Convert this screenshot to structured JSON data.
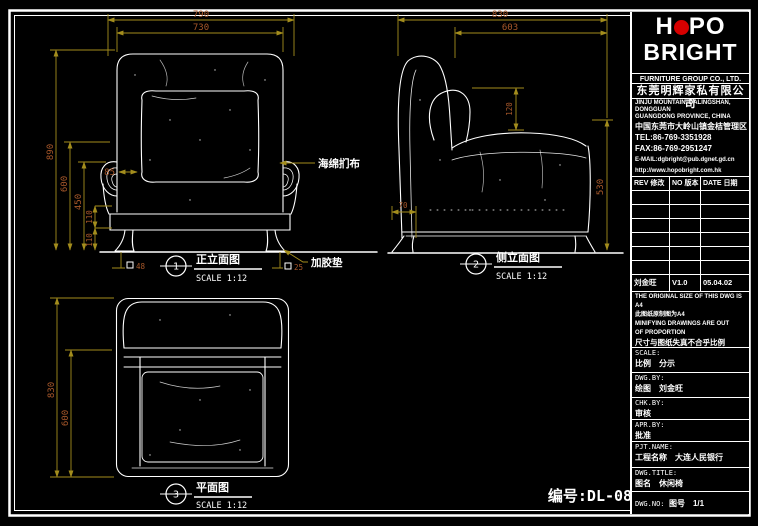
{
  "colors": {
    "dim_line": "#a38d1d",
    "dim_text": "#a8582a",
    "logo_red": "#d60000"
  },
  "frame": {
    "drawing_number": "编号:DL-08"
  },
  "views": {
    "front": {
      "number": "1",
      "title": "正立面图",
      "scale_label": "SCALE 1:12",
      "dims": {
        "width_outer": "790",
        "width_inner": "730",
        "height_total": "890",
        "height_back": "600",
        "height_arm": "450",
        "height_seat_upper": "110",
        "height_seat_lower": "110",
        "arm_width": "85",
        "leg_left": "48",
        "leg_right": "25"
      },
      "labels": {
        "upholstery": "海绵扪布",
        "glide": "加胶垫"
      }
    },
    "side": {
      "number": "2",
      "title": "侧立面图",
      "scale_label": "SCALE 1:12",
      "dims": {
        "depth_outer": "830",
        "depth_inner": "603",
        "back_offset": "120",
        "height_side": "530",
        "leg_inset": "70"
      }
    },
    "plan": {
      "number": "3",
      "title": "平面图",
      "scale_label": "SCALE 1:12",
      "dims": {
        "depth_outer": "830",
        "depth_seat": "600"
      }
    }
  },
  "title_block": {
    "logo": {
      "word1_a": "H",
      "word1_b": "PO",
      "word2": "BRIGHT"
    },
    "company_en": "FURNITURE GROUP CO., LTD.",
    "company_cn": "东莞明辉家私有限公司",
    "address_en_1": "JINJU MOUNTAIN, DALINGSHAN, DONGGUAN",
    "address_en_2": "GUANGDONG PROVINCE, CHINA",
    "address_cn": "中国东莞市大岭山镇金桔管理区",
    "tel": "TEL:86-769-3351928",
    "fax": "FAX:86-769-2951247",
    "email": "E-MAIL:dgbright@pub.dgnet.gd.cn",
    "website": "http://www.hopobright.com.hk",
    "rev_table": {
      "header_rev": "REV 修改",
      "header_no": "NO 版本",
      "header_date": "DATE 日期",
      "entry": {
        "name": "刘金旺",
        "version": "V1.0",
        "date": "05.04.02"
      }
    },
    "notes": [
      "THE ORIGINAL SIZE OF THIS DWG IS A4",
      "此图纸原制图为A4",
      "MINIFYING DRAWINGS ARE OUT",
      "OF PROPORTION",
      "尺寸与图纸失真不合乎比例"
    ],
    "fields": {
      "scale": {
        "label": "SCALE:",
        "cn": "比例",
        "value": "分示"
      },
      "dwg_by": {
        "label": "DWG.BY:",
        "cn": "绘图",
        "value": "刘金旺"
      },
      "chk_by": {
        "label": "CHK.BY:",
        "cn": "审核",
        "value": ""
      },
      "apr_by": {
        "label": "APR.BY:",
        "cn": "批准",
        "value": ""
      },
      "pjt_name": {
        "label": "PJT.NAME:",
        "cn": "工程名称",
        "value": "大连人民银行"
      },
      "dwg_title": {
        "label": "DWG.TITLE:",
        "cn": "图名",
        "value": "休闲椅"
      },
      "dwg_no": {
        "label": "DWG.NO:",
        "cn": "图号",
        "value": "1/1"
      }
    }
  }
}
